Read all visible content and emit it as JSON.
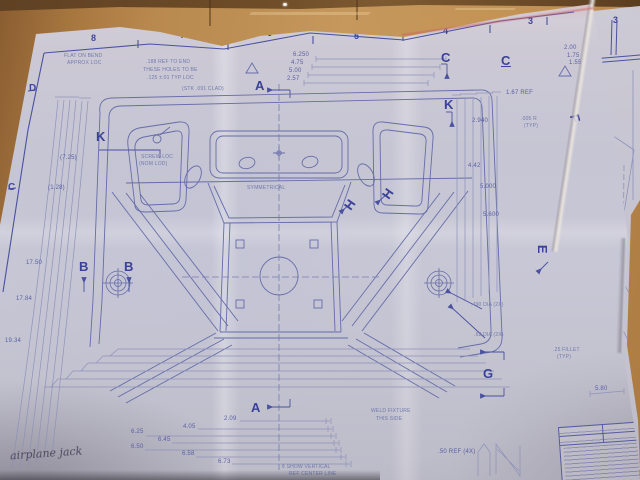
{
  "grid": {
    "c8": "8",
    "c7": "7",
    "c6": "6",
    "c5": "5",
    "c4": "4",
    "c3": "3",
    "sheet2_c3": "3",
    "rD": "D",
    "rC": "C"
  },
  "markers": {
    "a_top": "A",
    "a_bottom": "A",
    "b_left": "B",
    "b_right": "B",
    "c_arrow": "C",
    "c_label": "C",
    "e_side": "E",
    "f_side": "F",
    "g_side": "G",
    "h_left": "H",
    "h_right": "H",
    "k_left": "K",
    "k_top": "K"
  },
  "dims": {
    "b1": "2.09",
    "b2": "4.05",
    "b3": "6.25",
    "b4": "6.45",
    "b5": "6.50",
    "b6": "6.58",
    "b7": "6.73",
    "l1": "(7.25)",
    "l2": "(1.28)",
    "l3": "17.50",
    "l4": "17.84",
    "l5": "19.34",
    "r1": "2.940",
    "r2": "4.42",
    "r3": "5.000",
    "r4": "5.600",
    "r5": "1.67 REF",
    "r6": "2.00",
    "r7": "1.75",
    "r8": "1.55",
    "r9": "5.80",
    "t1": "6.250",
    "t2": "4.75",
    "t3": "5.00",
    "t4": "2.57",
    "m1": ".50 REF (4X)"
  },
  "notes": {
    "dia1": ".490 DIA (2X)",
    "dia2": ".62 DIA (2X)",
    "fillet1": ".25 FILLET",
    "fillet2": "(TYP)",
    "r005a": ".005 R",
    "r005b": "(TYP)",
    "weld1": "WELD FIXTURE",
    "weld2": "THIS SIDE",
    "sym": "SYMMETRICAL",
    "cl1": "¢ SHOW VERTICAL",
    "cl2": "REF CENTER LINE",
    "n1": ".188 REF TO END",
    "n2": "THESE HOLES TO BE",
    "n3": ".125 ±.01 TYP LOC",
    "n4": "(STK .091 CLAD)",
    "f1": "FLAT ON BEND",
    "f2": "APPROX LOC",
    "s1": "SCREW LOC",
    "s2": "(NOM LOD)"
  },
  "handwriting": {
    "text": "airplane jack"
  },
  "colors": {
    "cardboard": "#b98a4f",
    "paper": "#c6c5d3",
    "ink": "#5a5fa4",
    "ink_bold": "#3a4198"
  }
}
